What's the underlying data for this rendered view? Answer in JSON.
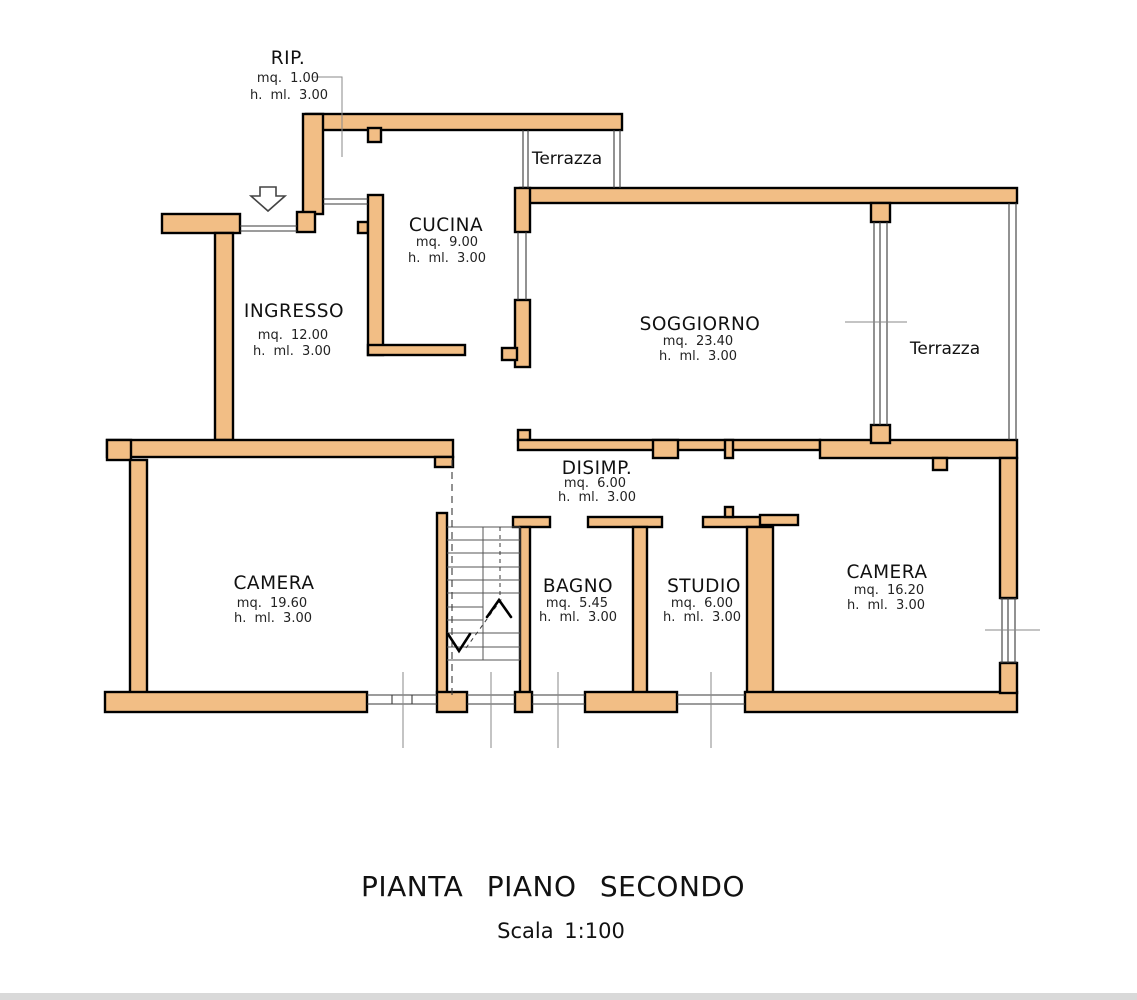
{
  "plan": {
    "title": "PIANTA PIANO SECONDO",
    "scale": "Scala 1:100",
    "wall_color": "#F2BE85",
    "rooms": [
      {
        "id": "rip",
        "name": "RIP.",
        "area": "mq. 1.00",
        "height": "h. ml. 3.00"
      },
      {
        "id": "terrazza-top",
        "name": "Terrazza",
        "area": "",
        "height": ""
      },
      {
        "id": "cucina",
        "name": "CUCINA",
        "area": "mq. 9.00",
        "height": "h. ml. 3.00"
      },
      {
        "id": "ingresso",
        "name": "INGRESSO",
        "area": "mq. 12.00",
        "height": "h. ml. 3.00"
      },
      {
        "id": "soggiorno",
        "name": "SOGGIORNO",
        "area": "mq. 23.40",
        "height": "h. ml. 3.00"
      },
      {
        "id": "terrazza-right",
        "name": "Terrazza",
        "area": "",
        "height": ""
      },
      {
        "id": "disimp",
        "name": "DISIMP.",
        "area": "mq. 6.00",
        "height": "h. ml. 3.00"
      },
      {
        "id": "camera-left",
        "name": "CAMERA",
        "area": "mq. 19.60",
        "height": "h. ml. 3.00"
      },
      {
        "id": "bagno",
        "name": "BAGNO",
        "area": "mq. 5.45",
        "height": "h. ml. 3.00"
      },
      {
        "id": "studio",
        "name": "STUDIO",
        "area": "mq. 6.00",
        "height": "h. ml. 3.00"
      },
      {
        "id": "camera-right",
        "name": "CAMERA",
        "area": "mq. 16.20",
        "height": "h. ml. 3.00"
      }
    ]
  }
}
